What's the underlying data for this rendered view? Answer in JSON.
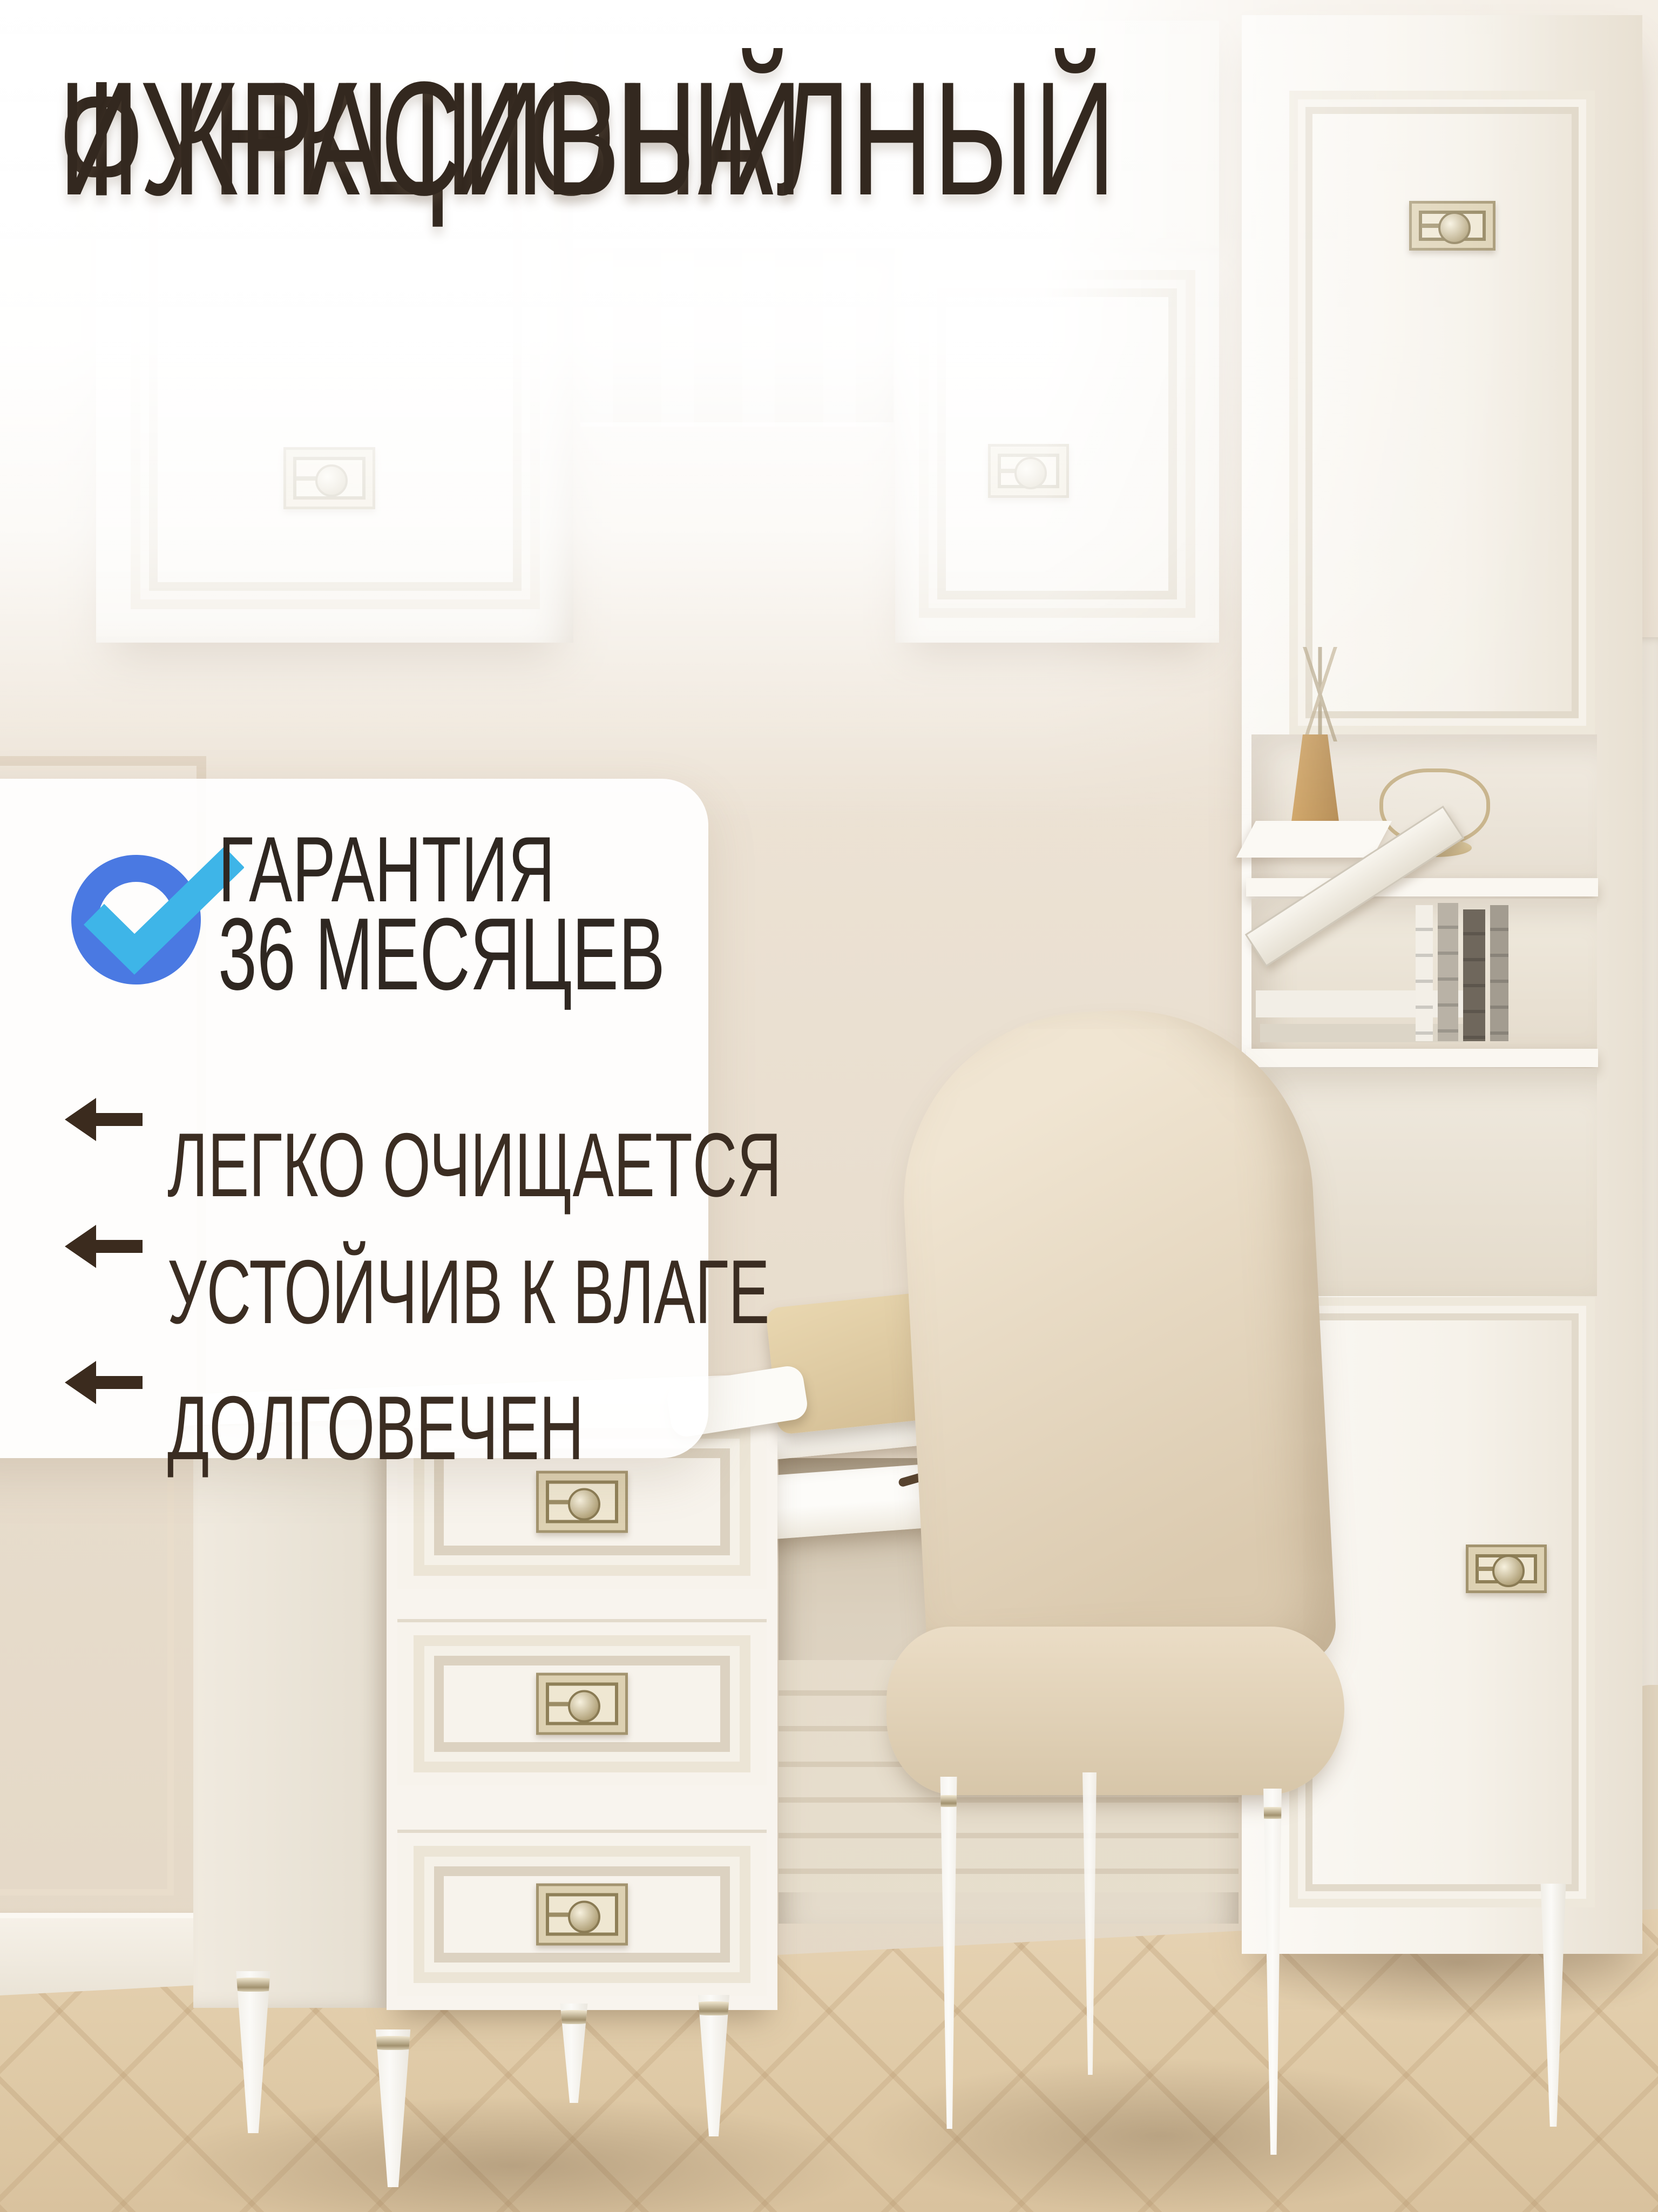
{
  "title": {
    "line1": "ФУНКЦИОНАЛНЫЙ",
    "line2": "И КРАСИВЫЙ"
  },
  "warranty": {
    "icon": "check-circle-icon",
    "line1": "ГАРАНТИЯ",
    "line2": "36 МЕСЯЦЕВ"
  },
  "features": [
    {
      "icon": "left-arrow-icon",
      "label": "ЛЕГКО ОЧИЩАЕТСЯ"
    },
    {
      "icon": "left-arrow-icon",
      "label": "УСТОЙЧИВ К ВЛАГЕ"
    },
    {
      "icon": "left-arrow-icon",
      "label": "ДОЛГОВЕЧЕН"
    }
  ],
  "colors": {
    "title_text": "#33281f",
    "body_text": "#3b2d22",
    "check_ring_blue": "#4a79e2",
    "check_mark_cyan": "#3eb5e8",
    "panel_background": "rgba(255,255,255,0.93)"
  }
}
